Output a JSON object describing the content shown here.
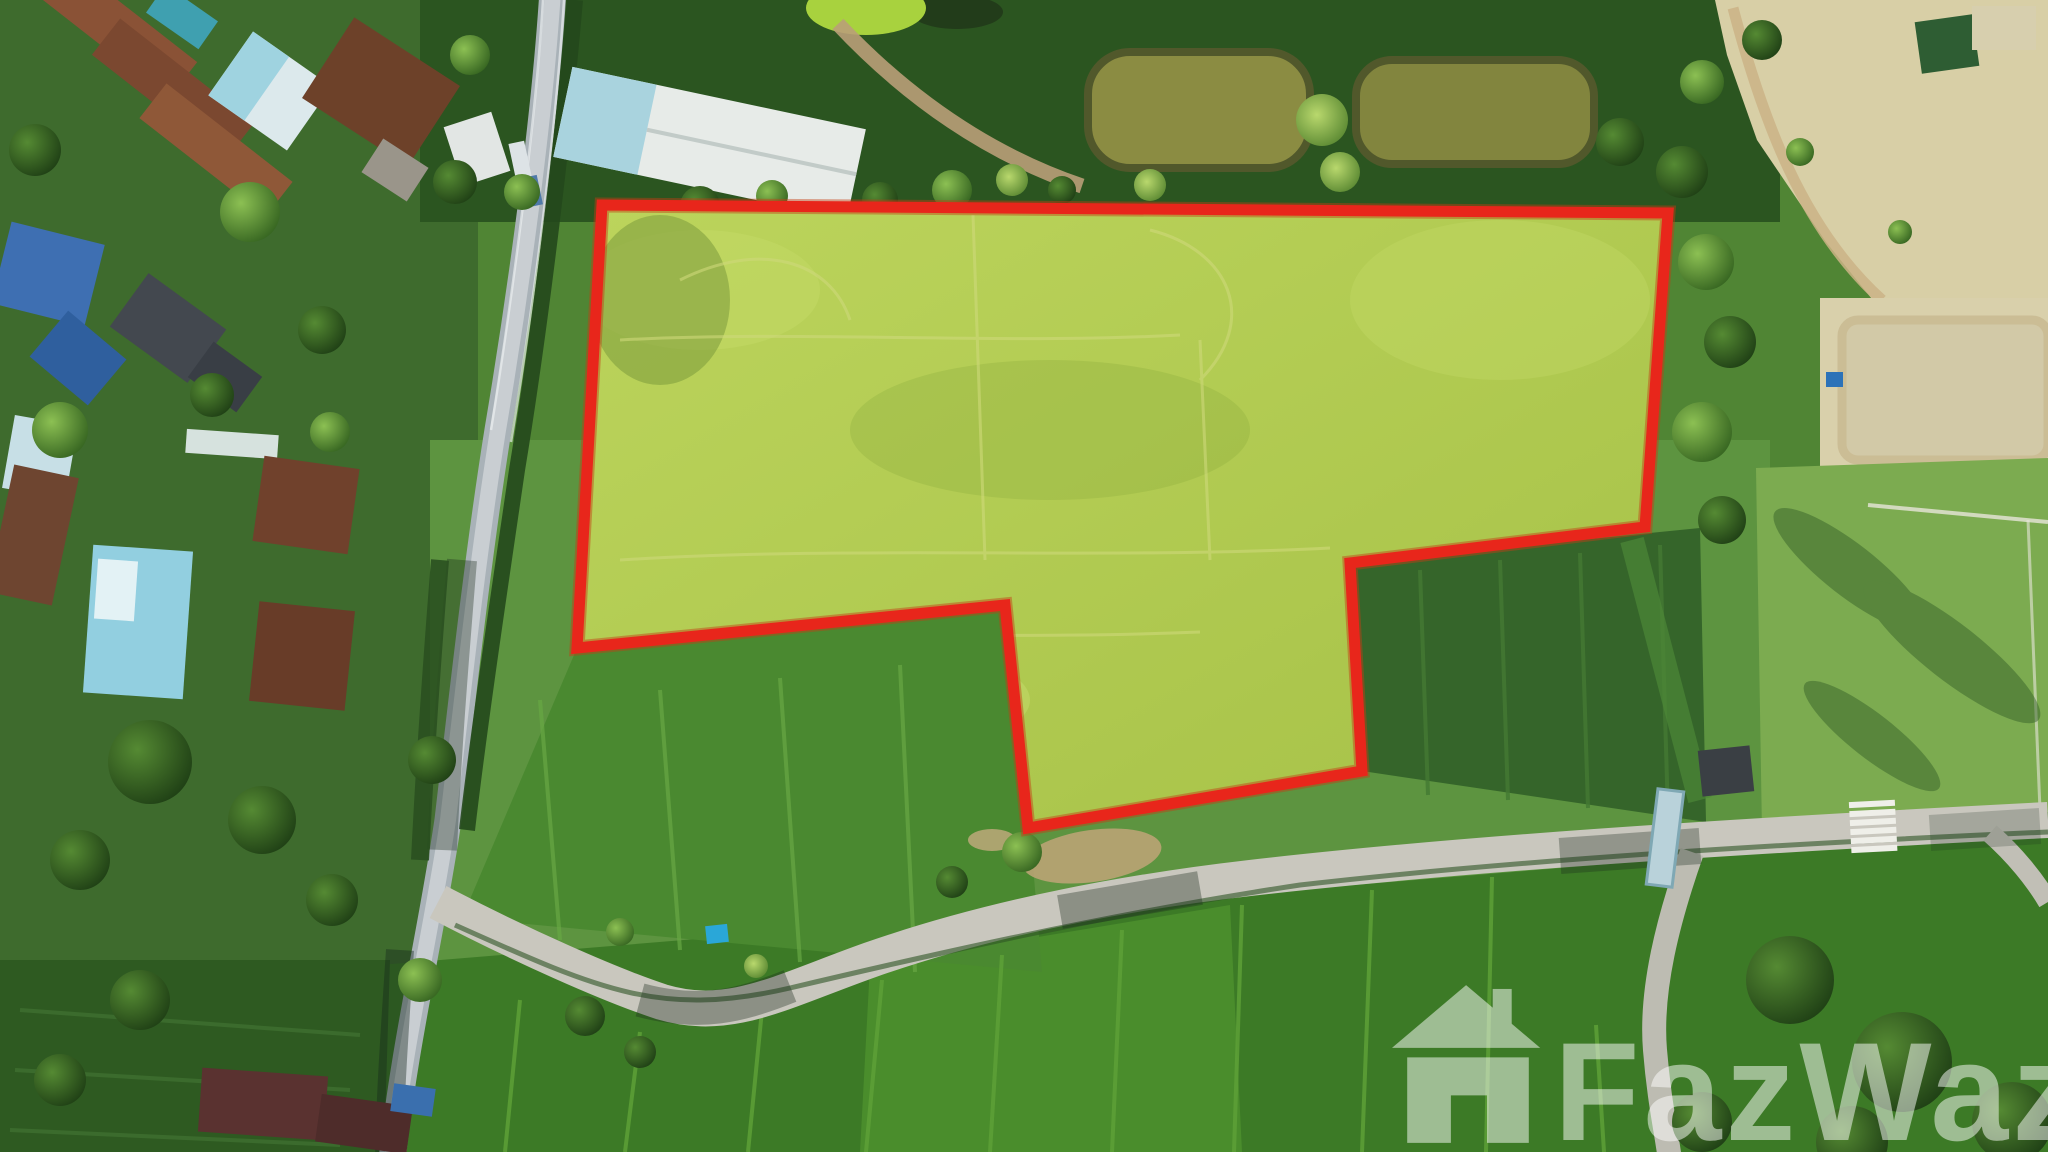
{
  "image": {
    "type": "aerial-drone-photo",
    "description": "Top-down aerial photo of a rural land plot for sale, outlined in red, beside a village road, rice paddies, ponds and houses",
    "width_px": 2048,
    "height_px": 1152
  },
  "watermark": {
    "text": "FazWaz",
    "icon": "house-logo-icon",
    "color": "#ffffff",
    "opacity": 0.5
  },
  "boundary": {
    "points": "602,205 1668,213 1645,527 1350,563 1362,771 1028,828 1005,605 577,648",
    "stroke": "#e8261b",
    "halo": "#c43d14",
    "stroke_width": 11,
    "fill": "url(#gPlot)"
  },
  "colors": {
    "boundary_red": "#e8261b",
    "plot_fill": "#b5cf52",
    "plot_fill_light": "#c6dc68",
    "base_green": "#508534",
    "left_band": "#3e6b2d",
    "top_band": "#2b5520",
    "grass_mid": "#5d9440",
    "paddy": "#3c7a26",
    "paddy_left": "#2e5a21",
    "paddy_mid": "#4a8930",
    "crop_dark": "#35652a",
    "road_asphalt": "#a9b2b8",
    "road_core": "#c9ced2",
    "road_concrete": "#c9c7be",
    "pond_olive": "#8b8c42",
    "pond_milky": "#d2c9a7",
    "sand": "#d8cfa6",
    "lawn": "#7cab50"
  }
}
